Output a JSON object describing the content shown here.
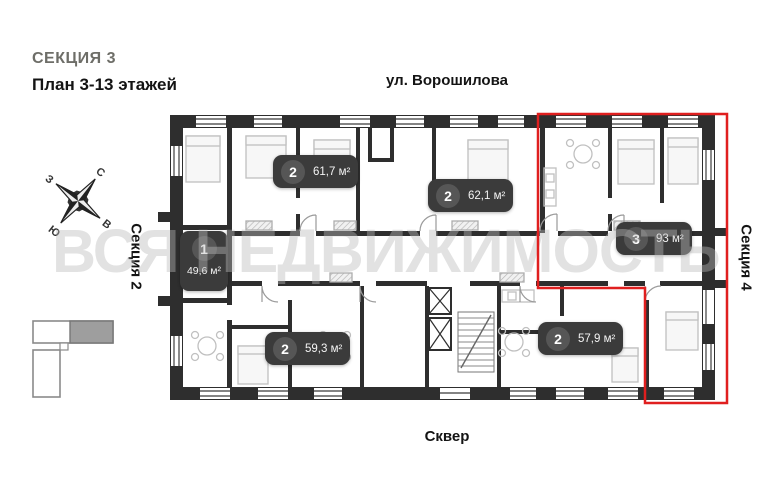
{
  "header": {
    "section_title": "СЕКЦИЯ 3",
    "plan_subtitle": "План 3-13 этажей"
  },
  "surroundings": {
    "street_top": "ул. Ворошилова",
    "bottom_area": "Сквер",
    "left_section": "Секция 2",
    "right_section": "Секция 4"
  },
  "compass": {
    "north": "С",
    "east": "В",
    "south": "Ю",
    "west": "З"
  },
  "watermark": "ВСЯ НЕДВИЖИМОСТЬ",
  "apartments": [
    {
      "rooms": "1",
      "area": "49,6 м²",
      "highlighted": false
    },
    {
      "rooms": "2",
      "area": "61,7 м²",
      "highlighted": false
    },
    {
      "rooms": "2",
      "area": "62,1 м²",
      "highlighted": false
    },
    {
      "rooms": "3",
      "area": "93 м²",
      "highlighted": true
    },
    {
      "rooms": "2",
      "area": "59,3 м²",
      "highlighted": false
    },
    {
      "rooms": "2",
      "area": "57,9 м²",
      "highlighted": false
    }
  ],
  "colors": {
    "wall": "#2e2e2e",
    "badge_bg": "#3b3b3b",
    "badge_circle": "#565656",
    "accent_red": "#e01f1f",
    "title_gray": "#6e6e68",
    "minimap_highlight": "#9e9e9e"
  }
}
